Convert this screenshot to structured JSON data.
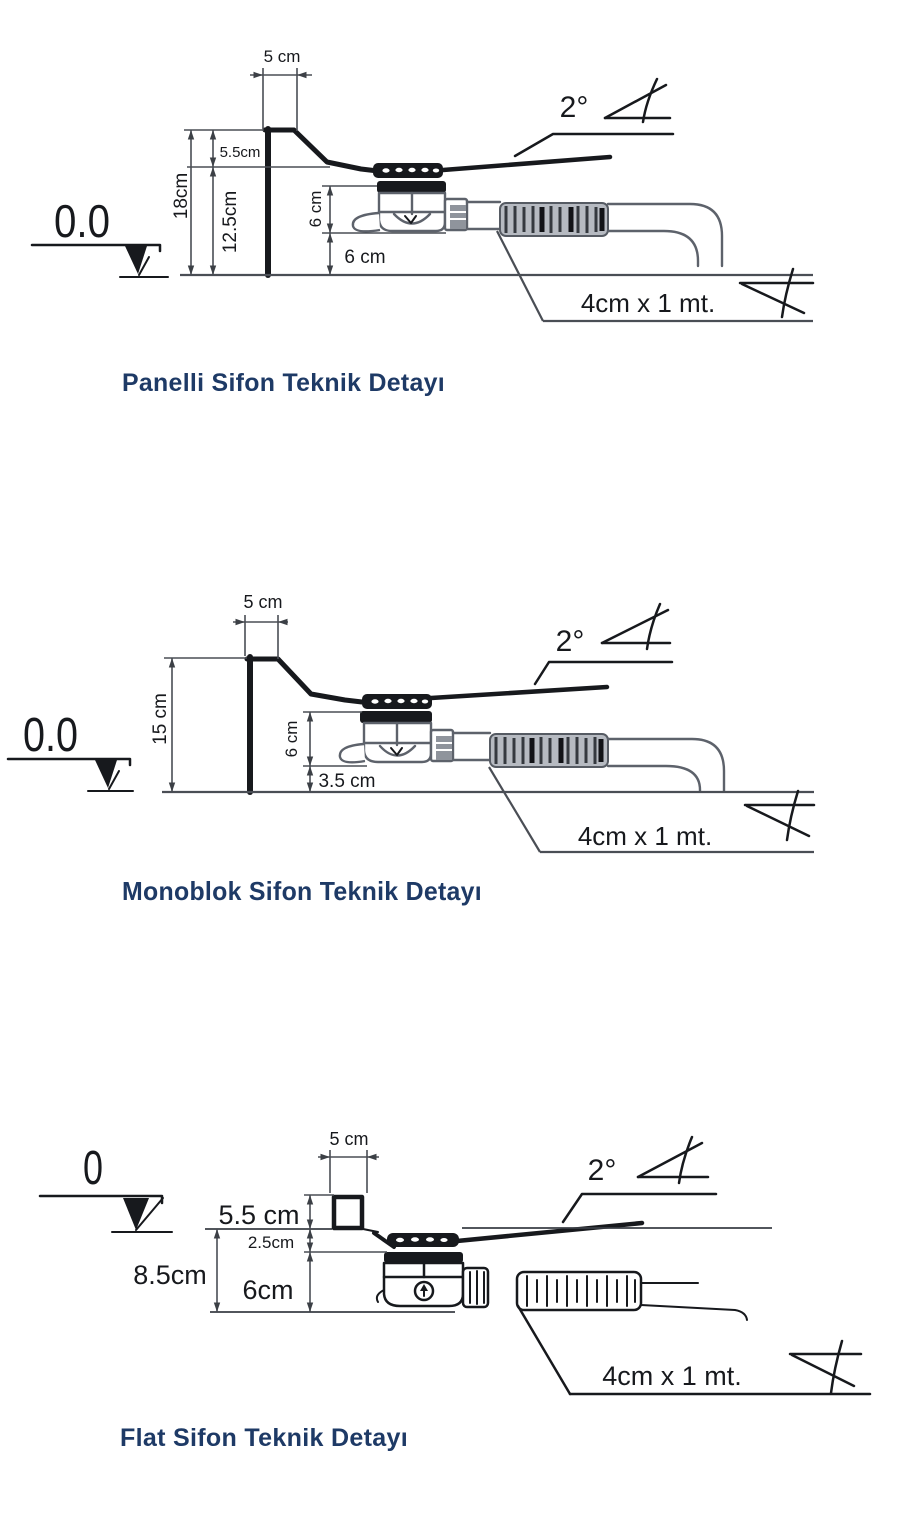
{
  "page": {
    "background": "#ffffff"
  },
  "colors": {
    "title_navy": "#1e3a66",
    "ink": "#17191d",
    "dim_gray": "#4a4e55"
  },
  "diagrams": {
    "panelli": {
      "title": "Panelli Sifon Teknik Detayı",
      "datum_level": "0.0",
      "dims": {
        "wall_top_width": "5 cm",
        "total_height": "18cm",
        "upper_height": "5.5cm",
        "lower_height": "12.5cm",
        "siphon_height": "6 cm",
        "floor_clearance": "6 cm"
      },
      "slope_angle": "2°",
      "drain_pipe": "4cm x 1 mt."
    },
    "monoblok": {
      "title": "Monoblok Sifon Teknik Detayı",
      "datum_level": "0.0",
      "dims": {
        "wall_top_width": "5 cm",
        "total_height": "15 cm",
        "siphon_height": "6 cm",
        "floor_clearance": "3.5 cm"
      },
      "slope_angle": "2°",
      "drain_pipe": "4cm x 1 mt."
    },
    "flat": {
      "title": "Flat Sifon Teknik Detayı",
      "datum_level": "0",
      "dims": {
        "curb_width": "5 cm",
        "curb_height": "5.5 cm",
        "recess_depth": "2.5cm",
        "total_depth": "8.5cm",
        "siphon_height": "6cm"
      },
      "slope_angle": "2°",
      "drain_pipe": "4cm x 1 mt."
    }
  }
}
